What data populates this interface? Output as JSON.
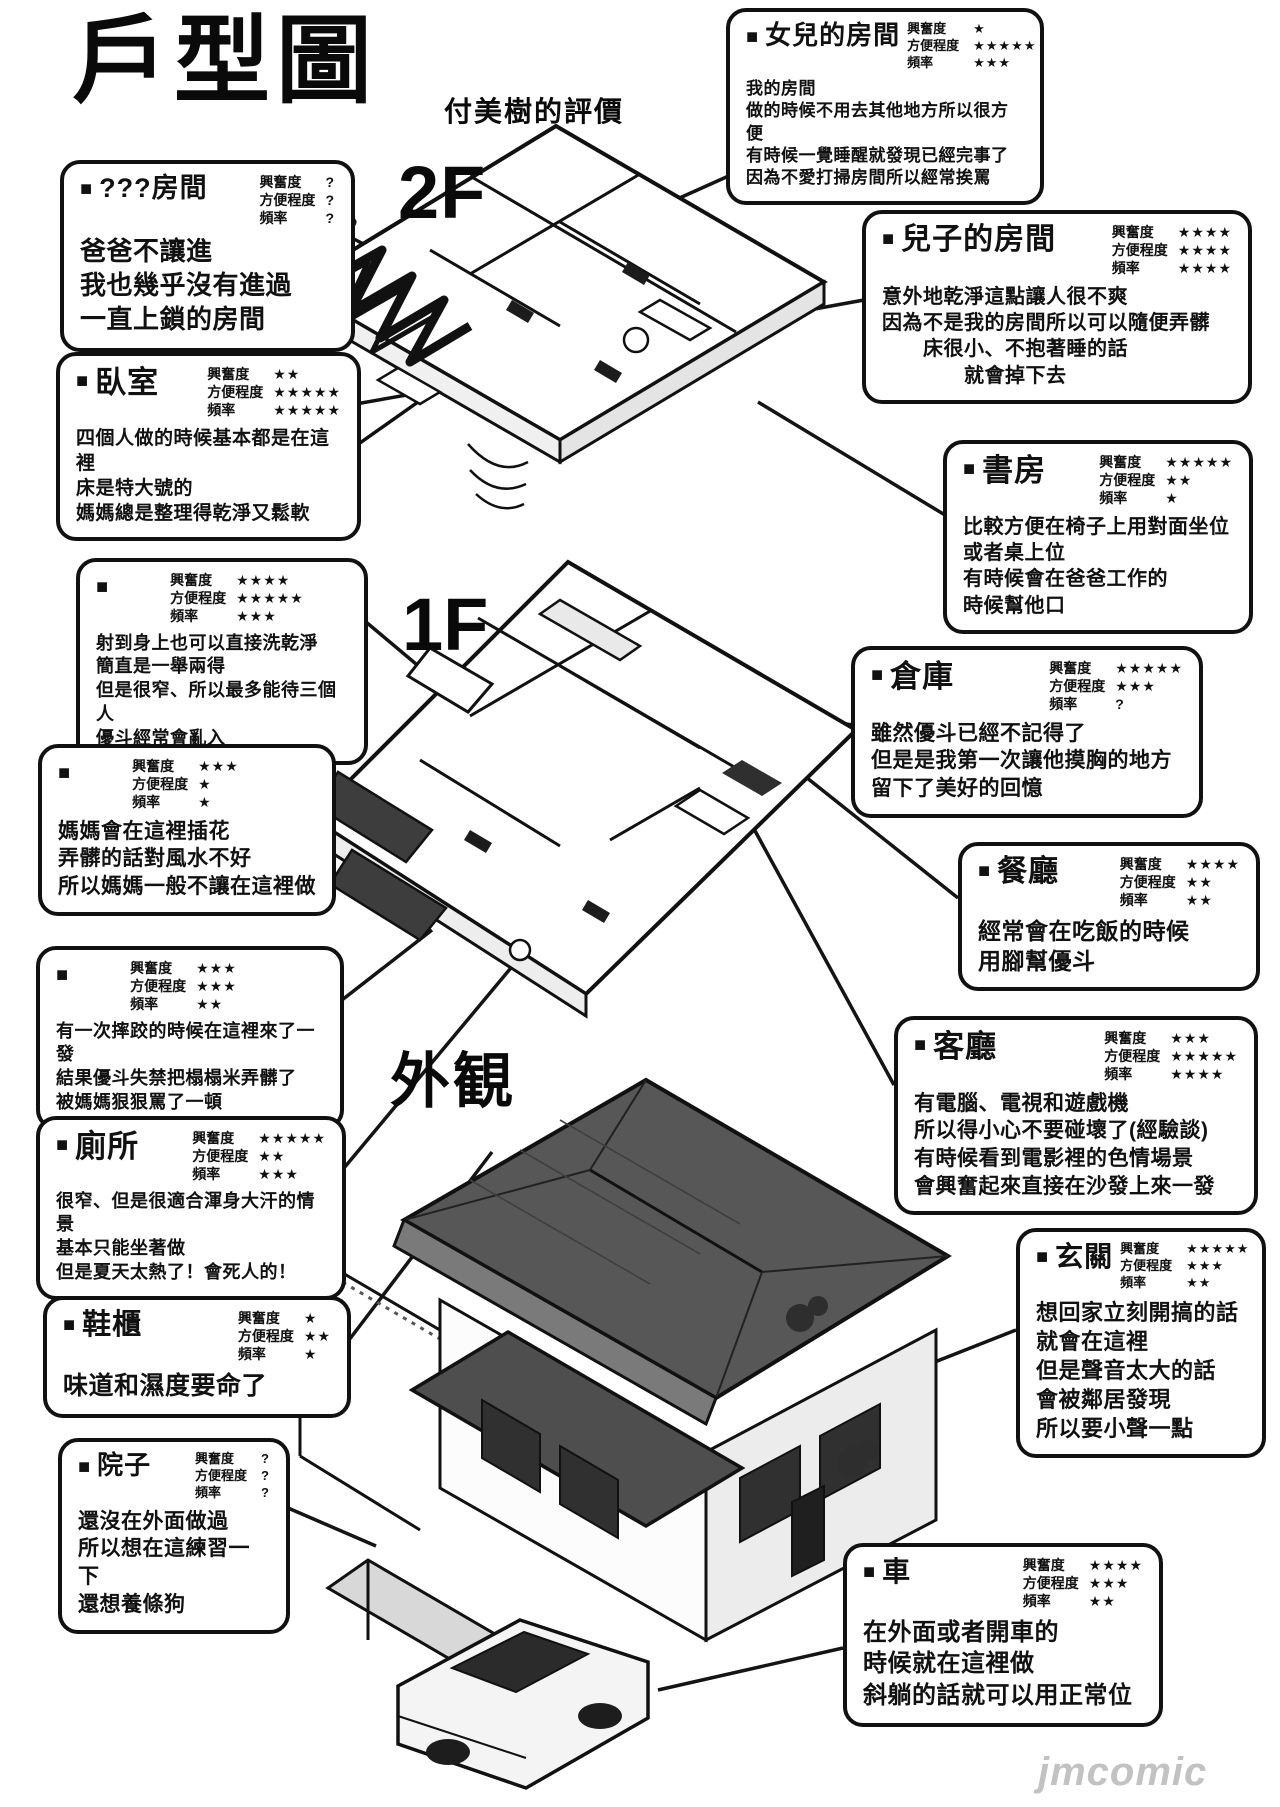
{
  "page": {
    "title": "戶型圖",
    "subtitle": "付美樹的評價",
    "floor_labels": {
      "second": "2F",
      "first": "1F",
      "exterior": "外観"
    },
    "bullet": "■",
    "watermark": "jmcomic",
    "colors": {
      "ink": "#111111",
      "roof_dark": "#575757",
      "roof_light": "#7a7a7a",
      "watermark_gray": "#c2c2c2"
    }
  },
  "ratings_labels": {
    "excitement": "興奮度",
    "convenience": "方便程度",
    "frequency": "頻率"
  },
  "rooms": [
    {
      "id": "daughter-room",
      "name": "女兒的房間",
      "excitement": "★",
      "convenience": "★★★★★",
      "frequency": "★★★",
      "body": "我的房間\n做的時候不用去其他地方所以很方便\n有時候一覺睡醒就發現已經完事了\n因為不愛打掃房間所以經常挨罵"
    },
    {
      "id": "unknown-room",
      "name": "???房間",
      "excitement": "?",
      "convenience": "?",
      "frequency": "?",
      "body": "爸爸不讓進\n我也幾乎沒有進過\n一直上鎖的房間"
    },
    {
      "id": "son-room",
      "name": "兒子的房間",
      "excitement": "★★★★",
      "convenience": "★★★★",
      "frequency": "★★★★",
      "body": "意外地乾淨這點讓人很不爽\n因為不是我的房間所以可以隨便弄髒\n　　床很小、不抱著睡的話\n　　　　就會掉下去"
    },
    {
      "id": "bedroom",
      "name": "臥室",
      "excitement": "★★",
      "convenience": "★★★★★",
      "frequency": "★★★★★",
      "body": "四個人做的時候基本都是在這裡\n床是特大號的\n媽媽總是整理得乾淨又鬆軟"
    },
    {
      "id": "study",
      "name": "書房",
      "excitement": "★★★★★",
      "convenience": "★★",
      "frequency": "★",
      "body": "比較方便在椅子上用對面坐位\n或者桌上位\n有時候會在爸爸工作的\n時候幫他口"
    },
    {
      "id": "bathroom",
      "name": "",
      "excitement": "★★★★",
      "convenience": "★★★★★",
      "frequency": "★★★",
      "body": "射到身上也可以直接洗乾淨\n簡直是一舉兩得\n但是很窄、所以最多能待三個人\n優斗經常會亂入"
    },
    {
      "id": "storage",
      "name": "倉庫",
      "excitement": "★★★★★",
      "convenience": "★★★",
      "frequency": "?",
      "body": "雖然優斗已經不記得了\n但是是我第一次讓他摸胸的地方\n留下了美好的回憶"
    },
    {
      "id": "flower-room",
      "name": "",
      "excitement": "★★★",
      "convenience": "★",
      "frequency": "★",
      "body": "媽媽會在這裡插花\n弄髒的話對風水不好\n所以媽媽一般不讓在這裡做"
    },
    {
      "id": "dining-room",
      "name": "餐廳",
      "excitement": "★★★★",
      "convenience": "★★",
      "frequency": "★★",
      "body": "經常會在吃飯的時候\n用腳幫優斗"
    },
    {
      "id": "tatami-room",
      "name": "",
      "excitement": "★★★",
      "convenience": "★★★",
      "frequency": "★★",
      "body": "有一次摔跤的時候在這裡來了一發\n結果優斗失禁把榻榻米弄髒了\n被媽媽狠狠罵了一頓"
    },
    {
      "id": "living-room",
      "name": "客廳",
      "excitement": "★★★",
      "convenience": "★★★★★",
      "frequency": "★★★★",
      "body": "有電腦、電視和遊戲機\n所以得小心不要碰壞了(經驗談)\n有時候看到電影裡的色情場景\n會興奮起來直接在沙發上來一發"
    },
    {
      "id": "toilet",
      "name": "廁所",
      "excitement": "★★★★★",
      "convenience": "★★",
      "frequency": "★★★",
      "body": "很窄、但是很適合渾身大汗的情景\n基本只能坐著做\n但是夏天太熱了！會死人的！"
    },
    {
      "id": "entrance",
      "name": "玄關",
      "excitement": "★★★★★",
      "convenience": "★★★",
      "frequency": "★★",
      "body": "想回家立刻開搞的話\n就會在這裡\n但是聲音太大的話\n會被鄰居發現\n所以要小聲一點"
    },
    {
      "id": "shoe-cabinet",
      "name": "鞋櫃",
      "excitement": "★",
      "convenience": "★★",
      "frequency": "★",
      "body": "味道和濕度要命了"
    },
    {
      "id": "yard",
      "name": "院子",
      "excitement": "?",
      "convenience": "?",
      "frequency": "?",
      "body": "還沒在外面做過\n所以想在這練習一下\n還想養條狗"
    },
    {
      "id": "car",
      "name": "車",
      "excitement": "★★★★",
      "convenience": "★★★",
      "frequency": "★★",
      "body": "在外面或者開車的\n時候就在這裡做\n斜躺的話就可以用正常位"
    }
  ]
}
